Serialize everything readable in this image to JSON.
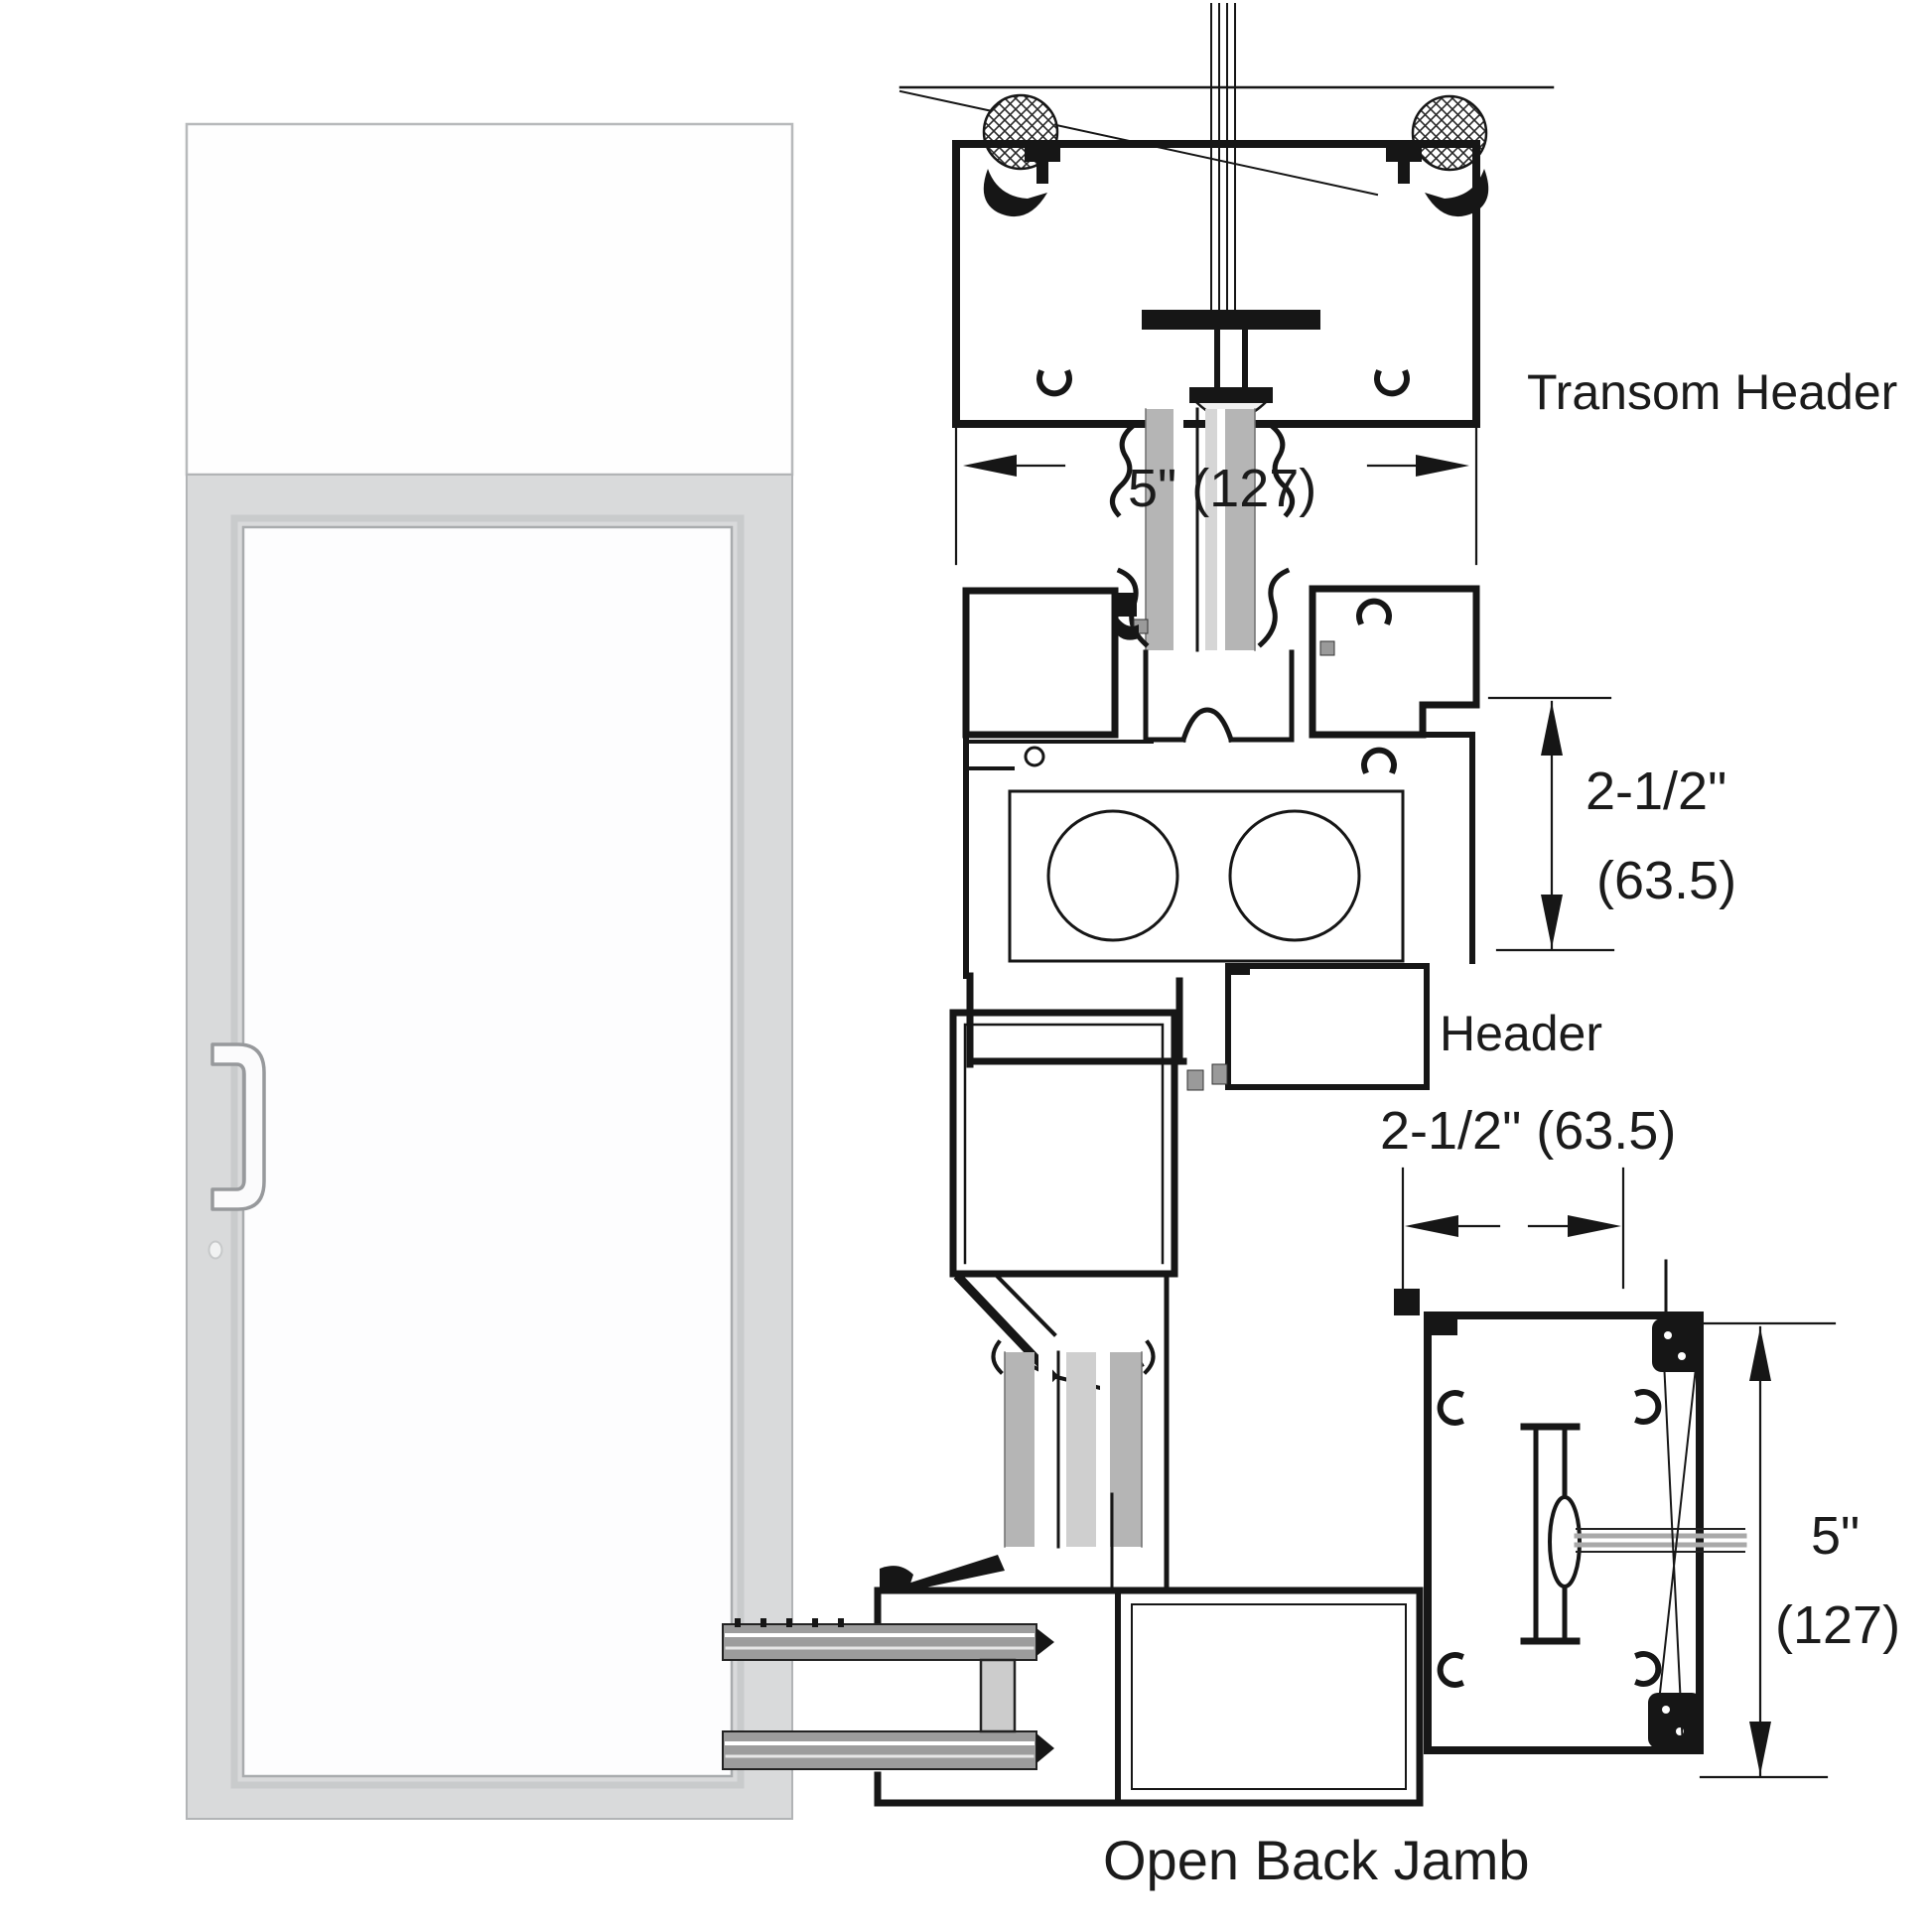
{
  "title": "Door transom header and open back jamb section details",
  "diagram": {
    "labels": {
      "transom_header": "Transom Header",
      "header": "Header",
      "open_back_jamb": "Open Back Jamb"
    },
    "dimensions": {
      "transom_frame_depth": "5\" (127)",
      "header_height_in": "2-1/2\"",
      "header_height_mm": "(63.5)",
      "jamb_face_width": "2-1/2\" (63.5)",
      "jamb_depth_in": "5\"",
      "jamb_depth_mm": "(127)"
    },
    "colors": {
      "line": "#161616",
      "glazing_gray": "#b5b5b5",
      "door_frame_gray": "#d9dadb",
      "door_stile_gray": "#9c9c9c",
      "background": "#ffffff"
    },
    "icons": {
      "pull_handle": "door-pull-handle",
      "lock_dot": "cylinder-lock-indicator",
      "backer_rod": "crosshatched-backer-rod"
    }
  }
}
